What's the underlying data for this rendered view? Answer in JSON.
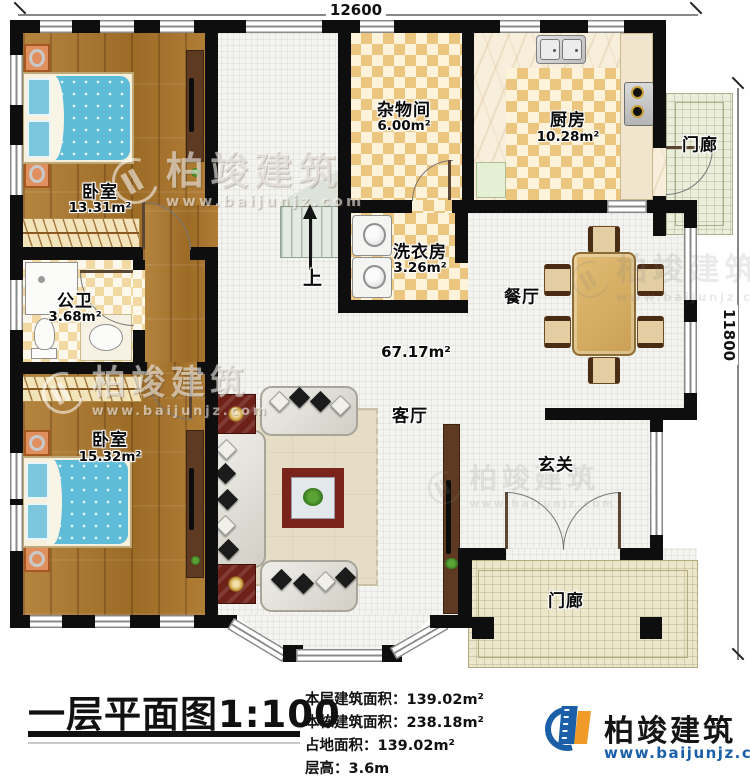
{
  "dimensions": {
    "width_mm": "12600",
    "height_mm": "11800"
  },
  "rooms": {
    "bedroom1": {
      "label": "卧室",
      "area": "13.31m²"
    },
    "storage": {
      "label": "杂物间",
      "area": "6.00m²"
    },
    "kitchen": {
      "label": "厨房",
      "area": "10.28m²"
    },
    "porch_top": {
      "label": "门廊"
    },
    "laundry": {
      "label": "洗衣房",
      "area": "3.26m²"
    },
    "bathroom": {
      "label": "公卫",
      "area": "3.68m²"
    },
    "dining": {
      "label": "餐厅"
    },
    "bedroom2": {
      "label": "卧室",
      "area": "15.32m²"
    },
    "living": {
      "label": "客厅",
      "area": "67.17m²"
    },
    "foyer": {
      "label": "玄关"
    },
    "porch_bottom": {
      "label": "门廊"
    }
  },
  "stairs": {
    "up_label": "上"
  },
  "title_block": {
    "title": "一层平面图",
    "scale": "1:100",
    "lines": [
      "本层建筑面积：139.02m²",
      "本栋建筑面积：238.18m²",
      "占地面积：139.02m²",
      "层高：3.6m"
    ]
  },
  "brand": {
    "name": "柏竣建筑",
    "website": "www.baijunjz.com"
  },
  "watermark": {
    "name": "柏竣建筑",
    "website": "www.baijunjz.com"
  },
  "colors": {
    "wall": "#0e0e0e",
    "wood_floor": "#a9782e",
    "tile_checker": "#ecc57f",
    "brand_blue": "#1b5fa8",
    "brand_orange": "#f09a28"
  }
}
